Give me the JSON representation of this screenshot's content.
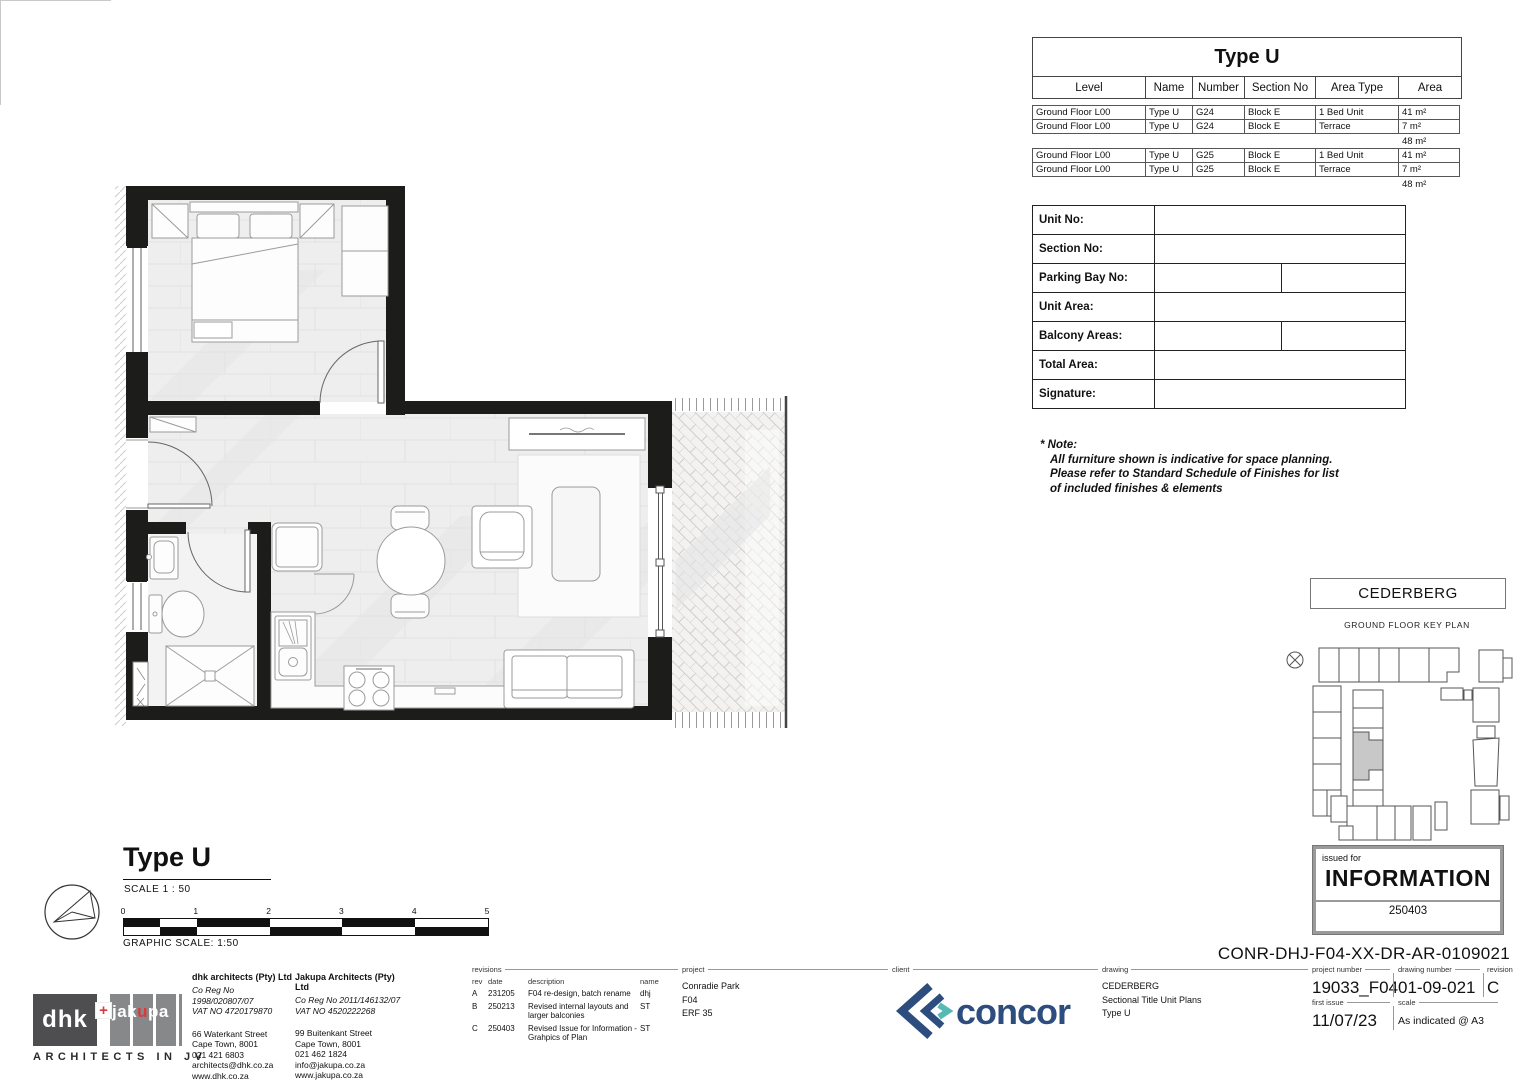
{
  "sheet": {
    "drawing_code": "CONR-DHJ-F04-XX-DR-AR-0109021"
  },
  "colors": {
    "wall": "#1c1c1a",
    "floor": "#efeeee",
    "concor_navy": "#2c4d7e",
    "concor_teal": "#56b9b4",
    "dhk_gray": "#4e4e50",
    "jakupa_gray": "#87888a",
    "logo_red": "#d93a3e",
    "keyplan_highlight": "#c8c8c8"
  },
  "unit_table": {
    "title": "Type U",
    "columns": [
      "Level",
      "Name",
      "Number",
      "Section No",
      "Area Type",
      "Area"
    ],
    "groups": [
      {
        "rows": [
          [
            "Ground Floor L00",
            "Type U",
            "G24",
            "Block E",
            "1 Bed Unit",
            "41 m²"
          ],
          [
            "Ground Floor L00",
            "Type U",
            "G24",
            "Block E",
            "Terrace",
            "7 m²"
          ]
        ],
        "total": "48 m²"
      },
      {
        "rows": [
          [
            "Ground Floor L00",
            "Type U",
            "G25",
            "Block E",
            "1 Bed Unit",
            "41 m²"
          ],
          [
            "Ground Floor L00",
            "Type U",
            "G25",
            "Block E",
            "Terrace",
            "7 m²"
          ]
        ],
        "total": "48 m²"
      }
    ]
  },
  "form_table": {
    "rows": [
      {
        "label": "Unit No:"
      },
      {
        "label": "Section No:"
      },
      {
        "label": "Parking Bay No:"
      },
      {
        "label": "Unit Area:"
      },
      {
        "label": "Balcony Areas:"
      },
      {
        "label": "Total Area:"
      },
      {
        "label": "Signature:"
      }
    ]
  },
  "note": {
    "lines": [
      "* Note:",
      "All furniture shown is indicative for space planning.",
      "Please refer to Standard Schedule of Finishes for list",
      "of included finishes & elements"
    ]
  },
  "key_plan": {
    "building": "CEDERBERG",
    "caption": "GROUND FLOOR KEY PLAN"
  },
  "issued_for": {
    "label": "issued for",
    "status": "INFORMATION",
    "code": "250403"
  },
  "plan_title": {
    "title": "Type U",
    "scale_text": "SCALE  1 : 50",
    "graphic_scale_text": "GRAPHIC SCALE: 1:50",
    "ticks": [
      "0",
      "1",
      "2",
      "3",
      "4",
      "5"
    ]
  },
  "floor_plan": {
    "rooms": [
      "bedroom",
      "bathroom",
      "living-kitchen",
      "terrace"
    ],
    "symbols": [
      "double-bed",
      "wardrobe",
      "bedside-table",
      "basin",
      "toilet",
      "shower",
      "fridge",
      "kitchen-sink",
      "stove",
      "dining-table",
      "dining-chair",
      "armchair",
      "rug",
      "coffee-table",
      "tv-unit",
      "sofa",
      "sliding-door",
      "door-swing",
      "north-arrow"
    ]
  },
  "title_block": {
    "architects": {
      "logo": {
        "dhk": "dhk",
        "plus": "+",
        "jakupa_pre": "jak",
        "jakupa_red": "u",
        "jakupa_post": "pa"
      },
      "jv_caption": "ARCHITECTS IN JV",
      "dhk": {
        "name": "dhk architects (Pty) Ltd",
        "reg": "Co Reg No 1998/020807/07",
        "vat": "VAT NO  4720179870",
        "address1": "66 Waterkant Street",
        "address2": "Cape Town, 8001",
        "phone": "021 421 6803",
        "email": "architects@dhk.co.za",
        "web": "www.dhk.co.za"
      },
      "jakupa": {
        "name": "Jakupa Architects (Pty) Ltd",
        "reg": "Co Reg No 2011/146132/07",
        "vat": "VAT NO  4520222268",
        "address1": "99 Buitenkant Street",
        "address2": "Cape Town, 8001",
        "phone": "021 462 1824",
        "email": "info@jakupa.co.za",
        "web": "www.jakupa.co.za"
      }
    },
    "revisions": {
      "label": "revisions",
      "col_rev": "rev",
      "col_date": "date",
      "col_desc": "description",
      "col_name": "name",
      "rows": [
        {
          "rev": "A",
          "date": "231205",
          "desc": "F04 re-design, batch rename",
          "name": "dhj"
        },
        {
          "rev": "B",
          "date": "250213",
          "desc": "Revised internal layouts and larger balconies",
          "name": "ST"
        },
        {
          "rev": "C",
          "date": "250403",
          "desc": "Revised Issue for Information - Grahpics of Plan",
          "name": "ST"
        }
      ]
    },
    "project": {
      "label": "project",
      "lines": [
        "Conradie Park",
        "F04",
        "ERF 35"
      ]
    },
    "client": {
      "label": "client",
      "logo_text": "concor"
    },
    "drawing": {
      "label": "drawing",
      "lines": [
        "CEDERBERG",
        "Sectional Title Unit Plans",
        "Type U"
      ]
    },
    "numbers": {
      "project_number_label": "project number",
      "project_number": "19033_F04",
      "first_issue_label": "first issue",
      "first_issue": "11/07/23",
      "drawing_number_label": "drawing number",
      "drawing_number": "01-09-021",
      "scale_label": "scale",
      "scale": "As indicated @ A3",
      "revision_label": "revision",
      "revision": "C"
    }
  }
}
